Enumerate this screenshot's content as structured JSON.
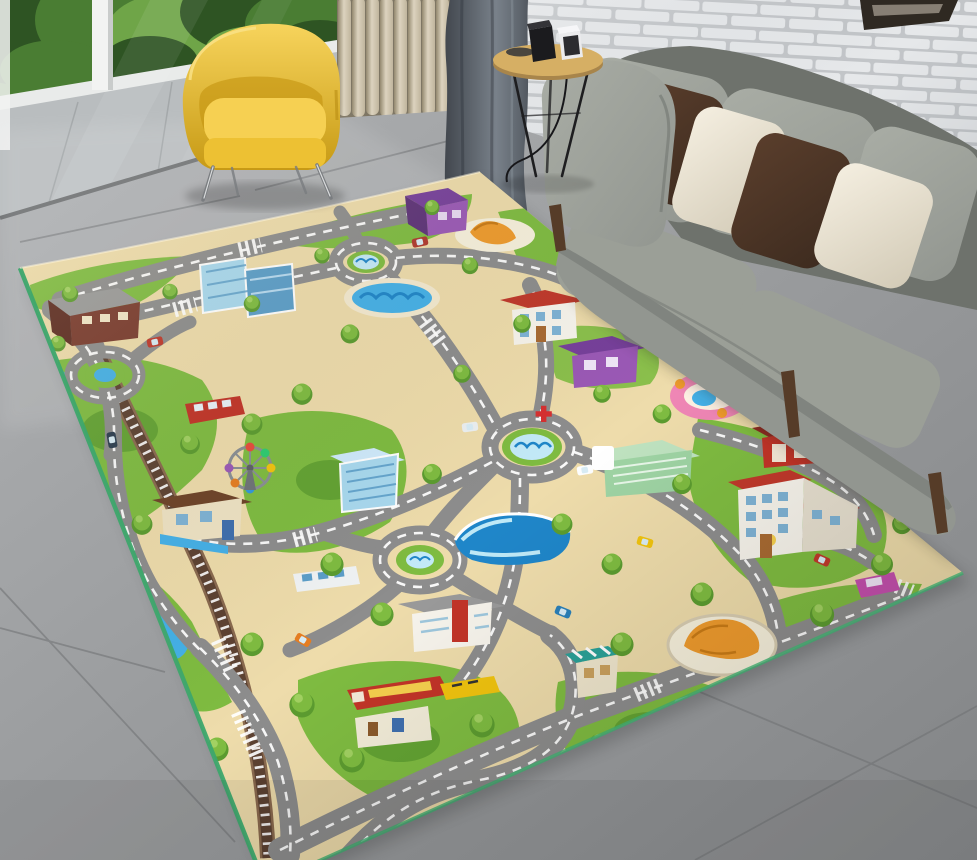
{
  "meta": {
    "description": "Photo of a modern living room: a large kids' city road play-mat rug covers a gray tile floor; a gray fabric sofa with dark-brown and cream pillows stands against a white brick wall; a yellow barrel armchair sits by a window with green foliage; a beige vertical-slat screen, a dark gray curtain and a small round wooden side table with two small black and white cube devices complete the scene."
  },
  "scene": {
    "wall": {
      "type": "white-painted-brick"
    },
    "window": {
      "view": "green-foliage-and-balcony",
      "frame": "white-posts"
    },
    "panel": {
      "type": "vertical-wood-slat-screen"
    },
    "curtain": {
      "color_name": "dark-slate-gray"
    },
    "picture_frame": {
      "position": "top-right-corner",
      "color_name": "dark-wood"
    },
    "furniture": [
      {
        "name": "yellow-armchair",
        "legs": "chrome-hairpin"
      },
      {
        "name": "gray-sofa",
        "pillows": [
          "gray",
          "dark-brown",
          "cream",
          "dark-brown",
          "cream"
        ],
        "legs": "dark-wood"
      },
      {
        "name": "round-side-table",
        "material": "wood",
        "items": [
          "dark-tray",
          "black-cube-device",
          "white-cube-device",
          "power-cord"
        ]
      }
    ],
    "rug": {
      "type": "kids-city-road-play-mat",
      "edge_binding": "green",
      "landmarks": [
        "roundabout-fountain-top",
        "roundabout-fountain-center",
        "roundabout-left",
        "roundabout-lower",
        "swimming-pool",
        "bakery-croissant-plaza",
        "purple-house-top",
        "purple-shop",
        "school-top",
        "school-right",
        "hospital",
        "fire-station",
        "playground-ring",
        "croissant-arena",
        "city-hall",
        "market-stall",
        "blue-glass-towers",
        "blue-glass-tower-south",
        "canopy-pool",
        "brown-building",
        "brown-roof-house",
        "ferris-wheel",
        "railway-with-crossings",
        "gas-station",
        "fire-truck",
        "yellow-truck",
        "red-bus",
        "white-bus",
        "magenta-car",
        "ponds",
        "trees",
        "zebra-crossings"
      ]
    },
    "floor": {
      "type": "large-gray-ceramic-tiles"
    }
  },
  "palette": {
    "floor_light": "#b0b2b4",
    "floor": "#97999b",
    "floor_dark": "#828486",
    "seam": "#6e7072",
    "balcony": "#b9bdbf",
    "curb": "#e9ebea",
    "skirting": "#6e7072",
    "leaf_dark": "#2e5423",
    "leaf": "#4a7d33",
    "leaf_light": "#6fa548",
    "post_white": "#f2f3f2",
    "slat_back": "#7e7664",
    "slat_light": "#dcd3bf",
    "slat": "#c0b59d",
    "slat_dark": "#94896f",
    "curtain": "#5f666e",
    "curtain_dark": "#42474e",
    "curtain_light": "#79818a",
    "brick": "#e6e8ea",
    "mortar": "#c2c5c8",
    "frame_dark": "#2f2922",
    "frame_inner": "#cfc7b8",
    "sofa": "#929690",
    "sofa_light": "#a9ada5",
    "sofa_dark": "#6e726c",
    "sofa_seat": "#9b9f97",
    "pillow_brown": "#3d2b1f",
    "pillow_brown_light": "#5a3e2c",
    "pillow_cream": "#ece5d4",
    "pillow_cream_dark": "#d2cab6",
    "wood_leg": "#563c28",
    "chair_yellow": "#f1c232",
    "chair_yellow_dark": "#c79a15",
    "chair_yellow_light": "#f7d45c",
    "chrome": "#7a7d80",
    "table_wood": "#d6af64",
    "table_wood_dark": "#a8854b",
    "device_black": "#1b1b1e",
    "device_white": "#ebebed",
    "rug_base": "#eedcab",
    "rug_sand": "#e3cd92",
    "grass": "#7fbc41",
    "grass_dark": "#5c9c30",
    "grass_light": "#a2d162",
    "road": "#8d8d8d",
    "road_dark": "#7b7b7b",
    "rail": "#5d4232",
    "rail_light": "#8a6a4f",
    "water": "#45b1e8",
    "water_dark": "#1f86c9",
    "water_light": "#c3eaf8",
    "roof_red": "#c0392b",
    "wall_white": "#f7f4ec",
    "win_blue": "#7fb3d5",
    "brown_bldg": "#7a3b2e",
    "roof_gray": "#9a9a9a",
    "glass_blue": "#a9d9ef",
    "glass_dark": "#5b9ec9",
    "purple": "#9b59b6",
    "purple_dark": "#77409b",
    "pink": "#ef86b5",
    "orange": "#ef9b2d",
    "red": "#c23428",
    "teal": "#2aa198",
    "hosp_green": "#bfe3c0",
    "cross_red": "#d63031",
    "edge_green": "#3da66b"
  }
}
